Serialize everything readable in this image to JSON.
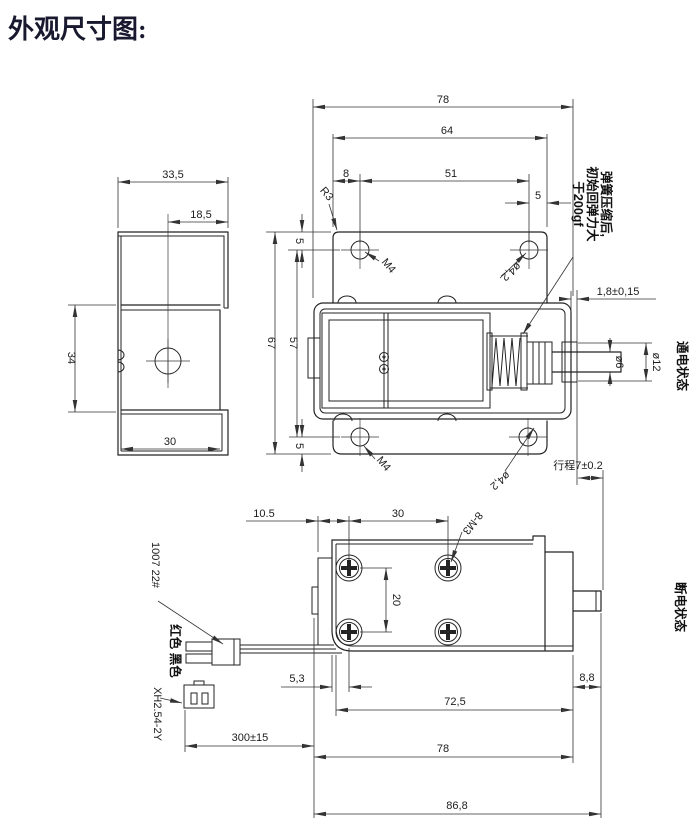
{
  "title": "外观尺寸图:",
  "colors": {
    "line": "#232323",
    "dim_line": "#333333",
    "title_text": "#18182e",
    "background": "#ffffff"
  },
  "front_view": {
    "dims": {
      "overall_width": "78",
      "plate_width": "64",
      "hole_offset": "8",
      "hole_spacing": "51",
      "right_edge_offset": "5",
      "top_edge_offset": "5",
      "overall_height": "67",
      "inner_height": "57",
      "bottom_edge_offset": "5",
      "corner_radius": "R3",
      "thread_top": "M4",
      "hole_dia_top": "ø4,2",
      "thread_bottom": "M4",
      "hole_dia_bottom": "ø4,2",
      "wall_thickness": "1,8±0,15",
      "shaft_dia": "ø6",
      "bushing_dia": "ø12",
      "stroke": "行程7±0.2"
    },
    "spring_note_line1": "弹簧压缩后,",
    "spring_note_line2": "初始回弹力大",
    "spring_note_line3": "于200gf",
    "state_label": "通电状态"
  },
  "side_view": {
    "dims": {
      "top_width": "33,5",
      "hole_to_edge": "18,5",
      "web_height": "34",
      "bottom_width": "30"
    }
  },
  "bottom_view": {
    "dims": {
      "left_offset": "10.5",
      "hole_spacing_x": "30",
      "hole_spacing_y": "20",
      "thread_holes": "8-M3",
      "wire_offset": "5,3",
      "body_length": "72,5",
      "tip_length": "8,8",
      "case_length": "78",
      "total_length": "86,8",
      "wire_length": "300±15"
    },
    "state_label": "断电状态",
    "wire_spec": "1007 22#",
    "wire_colors": "红色 黑色",
    "connector_type": "XH2.54-2Y"
  }
}
